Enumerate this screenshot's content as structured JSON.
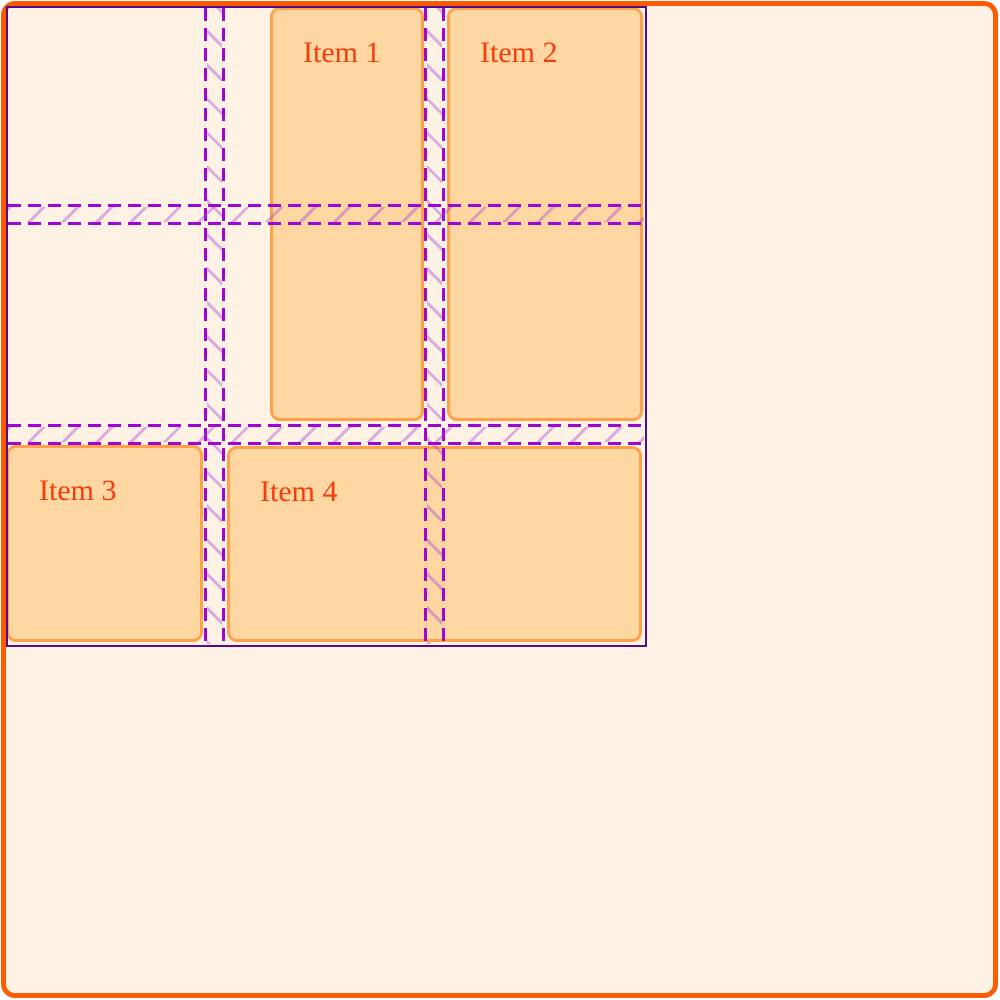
{
  "page": {
    "description": "Demo page with CSS grid gap inspector overlay",
    "colors": {
      "canvas_bg": "#fdf2e4",
      "frame_border": "#fe5b00",
      "item_fill": "#fdd6a2",
      "item_border": "#ffa148",
      "item_text": "#f63c0b",
      "overlay_outline": "#530c8a",
      "overlay_line": "#9e06d6",
      "overlay_hatch": "rgba(158, 61, 216, 0.38)"
    }
  },
  "grid": {
    "columns": 3,
    "rows": 3,
    "gap_px": 20,
    "items": [
      {
        "label": "Item 1"
      },
      {
        "label": "Item 2"
      },
      {
        "label": "Item 3"
      },
      {
        "label": "Item 4"
      }
    ]
  }
}
